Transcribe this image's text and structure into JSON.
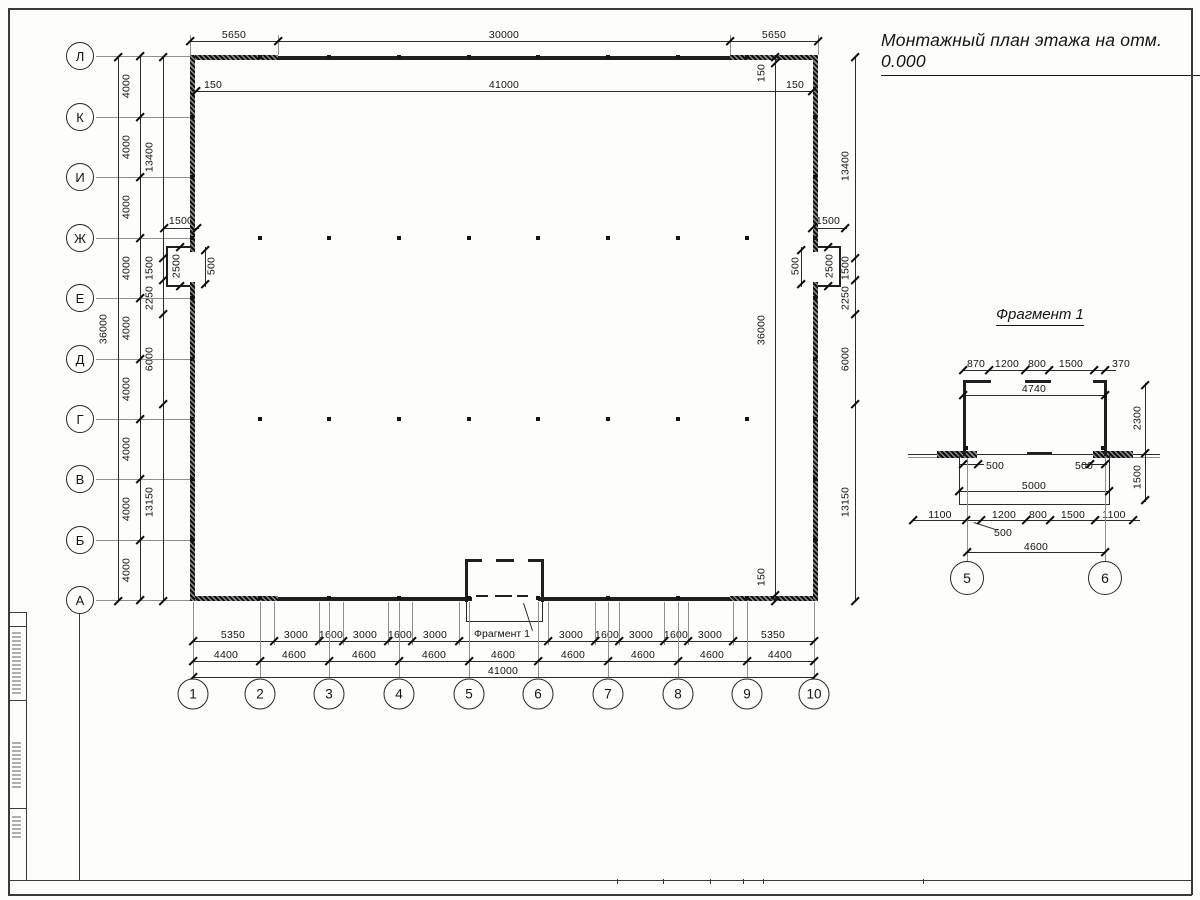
{
  "sheet": {
    "title": "Монтажный план этажа на отм. 0.000"
  },
  "plan": {
    "axis_rows": [
      "Л",
      "К",
      "И",
      "Ж",
      "Е",
      "Д",
      "Г",
      "В",
      "Б",
      "А"
    ],
    "axis_cols": [
      "1",
      "2",
      "3",
      "4",
      "5",
      "6",
      "7",
      "8",
      "9",
      "10"
    ],
    "dim_top": [
      "5650",
      "30000",
      "5650"
    ],
    "dim_top_inner": [
      "150",
      "41000",
      "150"
    ],
    "dim_left_total": "36000",
    "dim_left_steps": [
      "4000",
      "4000",
      "4000",
      "4000",
      "4000",
      "4000",
      "4000",
      "4000",
      "4000"
    ],
    "dim_left_inner": [
      "13400",
      "1500",
      "2250",
      "6000",
      "13150"
    ],
    "dim_right_outer": [
      "13400",
      "1500",
      "2250",
      "6000",
      "13150"
    ],
    "dim_right_inner": [
      "150",
      "36000",
      "150"
    ],
    "left_niche": {
      "width": "1500",
      "depth": "2500",
      "opening": "500"
    },
    "right_niche": {
      "width": "1500",
      "depth": "2500",
      "opening": "500"
    },
    "dim_bottom_row1": [
      "5350",
      "3000",
      "1600",
      "3000",
      "1600",
      "3000",
      "3000",
      "1600",
      "3000",
      "1600",
      "3000",
      "5350"
    ],
    "dim_bottom_row2": [
      "4400",
      "4600",
      "4600",
      "4600",
      "4600",
      "4600",
      "4600",
      "4600",
      "4400"
    ],
    "dim_bottom_total": "41000",
    "fragment_callout": "Фрагмент 1"
  },
  "fragment": {
    "title": "Фрагмент 1",
    "dim_top": [
      "870",
      "1200",
      "800",
      "1500",
      "370"
    ],
    "dim_inner_width": "4740",
    "dim_right_upper": "2300",
    "dim_right_lower": "1500",
    "dim_500_left": "500",
    "dim_500_right": "500",
    "dim_width_5000": "5000",
    "dim_bottom": [
      "1100",
      "1200",
      "800",
      "1500",
      "1100"
    ],
    "leader_500": "500",
    "dim_axis_span": "4600",
    "axis_cols": [
      "5",
      "6"
    ]
  }
}
